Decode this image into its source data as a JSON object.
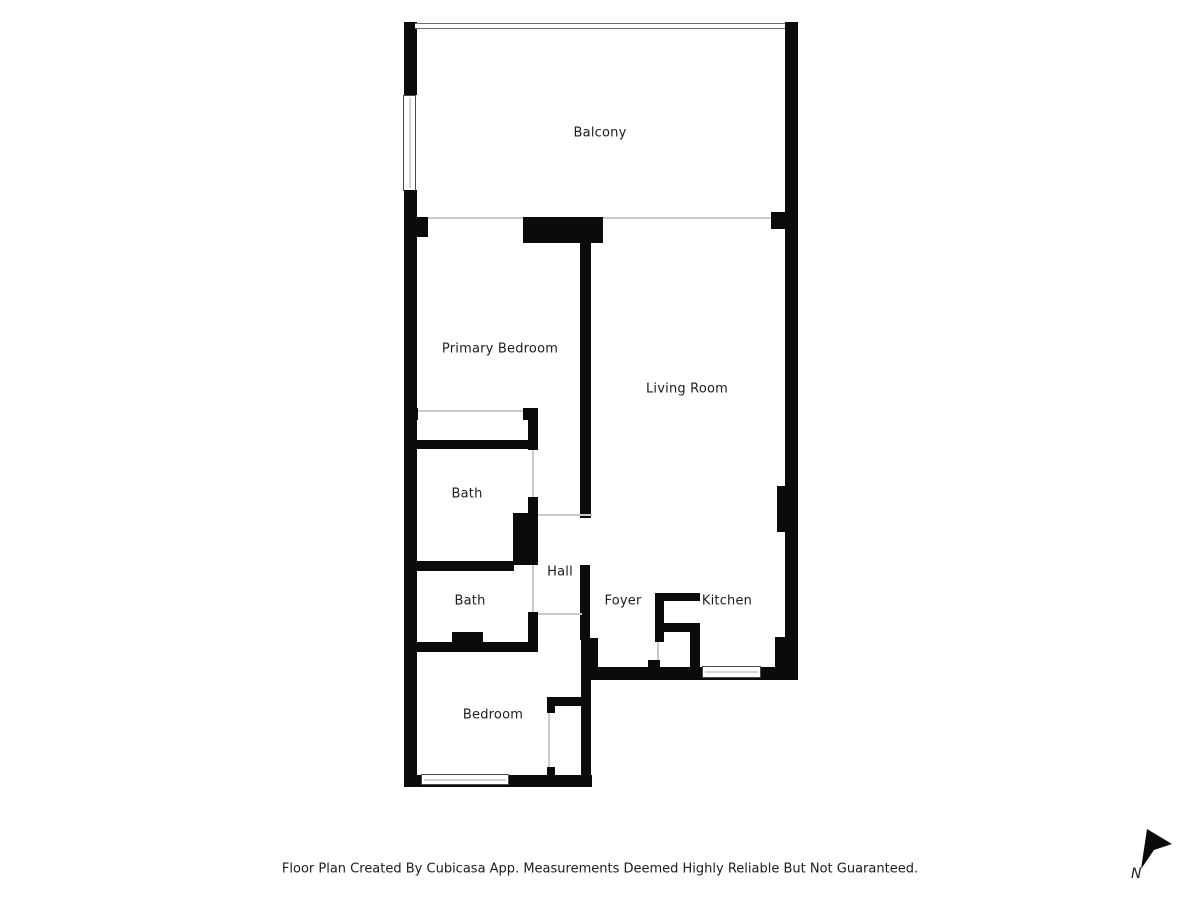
{
  "rooms": {
    "balcony": {
      "label": "Balcony"
    },
    "primary_bedroom": {
      "label": "Primary Bedroom"
    },
    "living_room": {
      "label": "Living Room"
    },
    "bath1": {
      "label": "Bath"
    },
    "bath2": {
      "label": "Bath"
    },
    "hall": {
      "label": "Hall"
    },
    "foyer": {
      "label": "Foyer"
    },
    "kitchen": {
      "label": "Kitchen"
    },
    "bedroom": {
      "label": "Bedroom"
    }
  },
  "footer": {
    "disclaimer": "Floor Plan Created By Cubicasa App. Measurements Deemed Highly Reliable But Not Guaranteed."
  },
  "compass": {
    "label": "N"
  },
  "colors": {
    "wall": "#0b0b0b",
    "background": "#ffffff",
    "text": "#1c1c1c",
    "opening_line": "#c9c9c9",
    "window_border": "#4a4a4a"
  }
}
